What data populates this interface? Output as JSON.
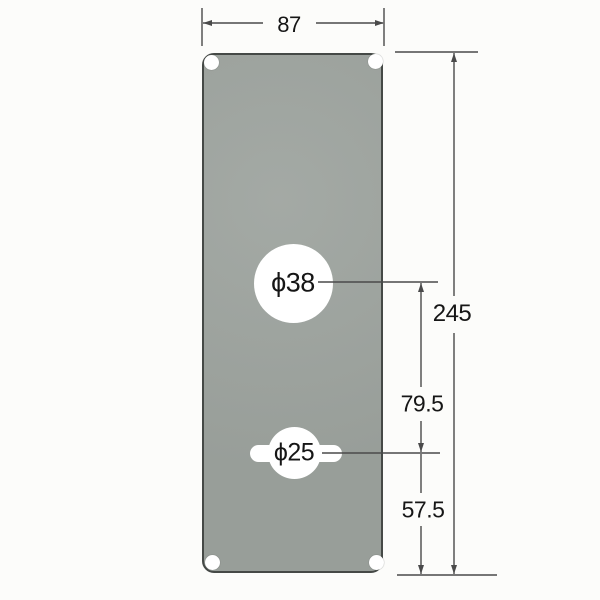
{
  "labels": {
    "width_mm": "87",
    "height_mm": "245",
    "top_hole_dia": "ϕ38",
    "bottom_hole_dia": "ϕ25",
    "hole_center_distance": "79.5",
    "bottom_hole_to_edge": "57.5"
  },
  "colors": {
    "background": "#fcfcfa",
    "plate_fill": "#9da39e",
    "plate_edge": "#454946",
    "dimension_line": "#4a4a4a",
    "text": "#161616",
    "hole_fill": "#ffffff"
  }
}
